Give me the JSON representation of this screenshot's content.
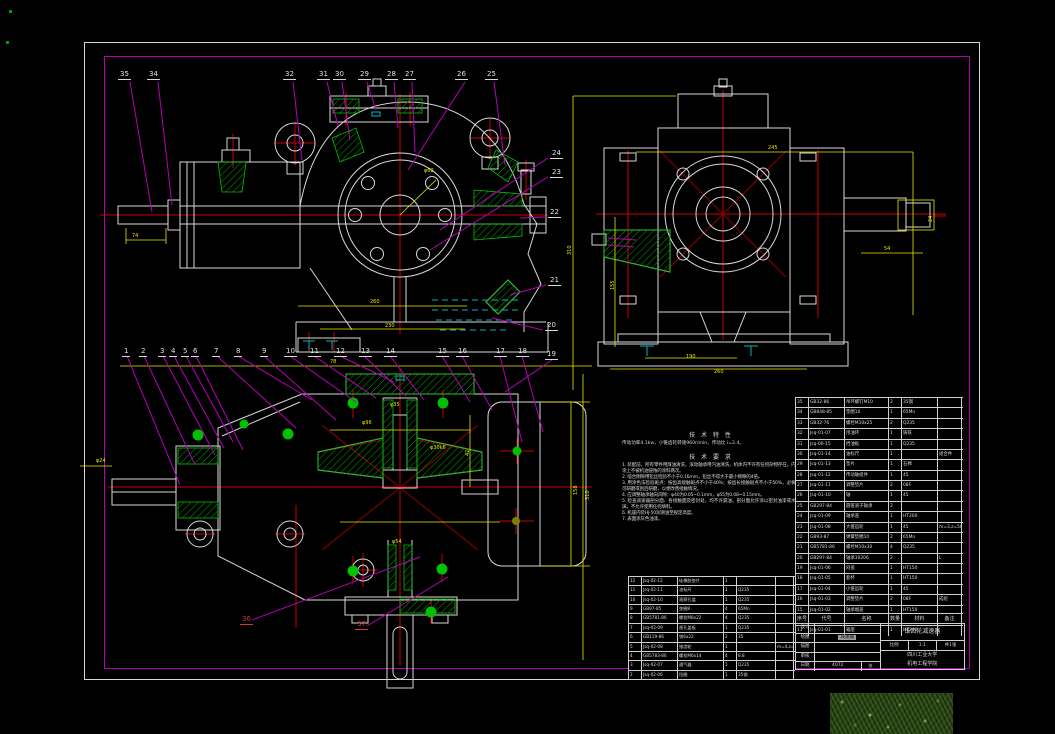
{
  "colors": {
    "background": "#000000",
    "line_white": "#d8d8d8",
    "leader_magenta": "#b800b8",
    "centerline_red": "#cc0000",
    "dim_yellow": "#e8e800",
    "hatch_green": "#00b000",
    "oil_cyan": "#00b8b8",
    "callout_text": "#e0e0e0"
  },
  "callouts": {
    "top": [
      {
        "t": "35",
        "x": 118,
        "y": 71
      },
      {
        "t": "34",
        "x": 147,
        "y": 71
      },
      {
        "t": "32",
        "x": 283,
        "y": 71
      },
      {
        "t": "31",
        "x": 317,
        "y": 71
      },
      {
        "t": "30",
        "x": 333,
        "y": 71
      },
      {
        "t": "29",
        "x": 358,
        "y": 71
      },
      {
        "t": "28",
        "x": 385,
        "y": 71
      },
      {
        "t": "27",
        "x": 403,
        "y": 71
      },
      {
        "t": "26",
        "x": 455,
        "y": 71
      },
      {
        "t": "25",
        "x": 485,
        "y": 71
      }
    ],
    "right": [
      {
        "t": "24",
        "x": 550,
        "y": 150
      },
      {
        "t": "23",
        "x": 550,
        "y": 169
      },
      {
        "t": "22",
        "x": 548,
        "y": 209
      },
      {
        "t": "21",
        "x": 548,
        "y": 277
      },
      {
        "t": "20",
        "x": 545,
        "y": 322
      }
    ],
    "bottom": [
      {
        "t": "1",
        "x": 122,
        "y": 348
      },
      {
        "t": "2",
        "x": 139,
        "y": 348
      },
      {
        "t": "3",
        "x": 158,
        "y": 348
      },
      {
        "t": "4",
        "x": 169,
        "y": 348
      },
      {
        "t": "5",
        "x": 181,
        "y": 348
      },
      {
        "t": "6",
        "x": 191,
        "y": 348
      },
      {
        "t": "7",
        "x": 212,
        "y": 348
      },
      {
        "t": "8",
        "x": 234,
        "y": 348
      },
      {
        "t": "9",
        "x": 260,
        "y": 348
      },
      {
        "t": "10",
        "x": 284,
        "y": 348
      },
      {
        "t": "11",
        "x": 308,
        "y": 348
      },
      {
        "t": "12",
        "x": 334,
        "y": 348
      },
      {
        "t": "13",
        "x": 359,
        "y": 348
      },
      {
        "t": "14",
        "x": 384,
        "y": 348
      },
      {
        "t": "15",
        "x": 436,
        "y": 348
      },
      {
        "t": "16",
        "x": 456,
        "y": 348
      },
      {
        "t": "17",
        "x": 494,
        "y": 348
      },
      {
        "t": "18",
        "x": 516,
        "y": 348
      },
      {
        "t": "19",
        "x": 545,
        "y": 351
      }
    ],
    "lower": [
      {
        "t": "36",
        "x": 240,
        "y": 616
      },
      {
        "t": "37",
        "x": 355,
        "y": 621
      }
    ]
  },
  "dims": [
    {
      "t": "74",
      "x": 132,
      "y": 234
    },
    {
      "t": "φ62",
      "x": 424,
      "y": 169
    },
    {
      "t": "260",
      "x": 370,
      "y": 300
    },
    {
      "t": "230",
      "x": 385,
      "y": 324
    },
    {
      "t": "245",
      "x": 768,
      "y": 146
    },
    {
      "t": "310",
      "x": 568,
      "y": 255,
      "r": -90
    },
    {
      "t": "155",
      "x": 611,
      "y": 290,
      "r": -90
    },
    {
      "t": "260",
      "x": 714,
      "y": 370
    },
    {
      "t": "190",
      "x": 686,
      "y": 355
    },
    {
      "t": "54",
      "x": 884,
      "y": 247
    },
    {
      "t": "24",
      "x": 929,
      "y": 222,
      "r": -90
    },
    {
      "t": "78",
      "x": 330,
      "y": 360
    },
    {
      "t": "φ24",
      "x": 96,
      "y": 459
    },
    {
      "t": "310",
      "x": 586,
      "y": 500,
      "r": -90
    },
    {
      "t": "158",
      "x": 574,
      "y": 495,
      "r": -90
    },
    {
      "t": "φ96",
      "x": 362,
      "y": 421
    },
    {
      "t": "42",
      "x": 466,
      "y": 456,
      "r": -90
    },
    {
      "t": "φ54",
      "x": 392,
      "y": 540
    },
    {
      "t": "φ35",
      "x": 390,
      "y": 403
    },
    {
      "t": "φ30k6",
      "x": 430,
      "y": 446
    }
  ],
  "notes": {
    "char_title": "技 术 特 性",
    "char_line": "传动功率4.1kw，小锥齿轮转速960r/min，传动比 i=2.4。",
    "req_title": "技 术 要 求",
    "items": [
      "1. 装配前，所有零件用煤油清洗，滚动轴承用汽油清洗，机体内不许有任何杂物存在。内壁涂上不被机油侵蚀的涂料两次。",
      "2. 啮合侧隙用铅丝检验不小于0.16mm，铅丝不得大于最小侧隙的4倍。",
      "3. 用涂色法检验斑点：按齿高接触斑点不小于40%；按齿长接触斑点不小于50%。必要时可研磨或刮后研磨，以便改善接触情况。",
      "4. 应调整轴承轴向间隙：φ40为0.05~0.1mm，φ55为0.08~0.15mm。",
      "5. 检查减速器剖分面、各接触面及密封处，均不许漏油。剖分面允许涂以密封油漆或水玻璃，不允许使用任何填料。",
      "6. 机座内装HJ-50润滑油至规定高度。",
      "7. 表面涂灰色油漆。"
    ]
  },
  "table_header": {
    "no": "序号",
    "code": "代号",
    "name": "名称",
    "qty": "数量",
    "mat": "材料",
    "note": "备注"
  },
  "bom_right": {
    "rows": [
      {
        "n": "35",
        "c": "GB32-86",
        "m": "吊环螺钉M10",
        "q": "2",
        "t": "35钢",
        "b": ""
      },
      {
        "n": "34",
        "c": "GB848-85",
        "m": "垫圈10",
        "q": "1",
        "t": "65Mn",
        "b": ""
      },
      {
        "n": "33",
        "c": "GB32-76",
        "m": "螺栓M10x25",
        "q": "2",
        "t": "Q235",
        "b": ""
      },
      {
        "n": "32",
        "c": "Jsq-01-07",
        "m": "甩油环",
        "q": "1",
        "t": "铸铁",
        "b": ""
      },
      {
        "n": "31",
        "c": "Jsq-00-15",
        "m": "挡油板",
        "q": "1",
        "t": "Q235",
        "b": ""
      },
      {
        "n": "30",
        "c": "Jsq-01-14",
        "m": "油标尺",
        "q": "1",
        "t": "",
        "b": "组合件"
      },
      {
        "n": "29",
        "c": "Jsq-01-13",
        "m": "垫片",
        "q": "1",
        "t": "石棉",
        "b": ""
      },
      {
        "n": "28",
        "c": "Jsq-01-12",
        "m": "传动轴组件",
        "q": "1",
        "t": "45",
        "b": ""
      },
      {
        "n": "27",
        "c": "Jsq-01-11",
        "m": "调整垫片",
        "q": "2",
        "t": "08F",
        "b": ""
      },
      {
        "n": "26",
        "c": "Jsq-01-10",
        "m": "轴",
        "q": "1",
        "t": "45",
        "b": ""
      },
      {
        "n": "25",
        "c": "GB297-84",
        "m": "圆锥滚子轴承",
        "q": "2",
        "t": "",
        "b": ""
      },
      {
        "n": "24",
        "c": "Jsq-01-09",
        "m": "轴承盖",
        "q": "1",
        "t": "HT200",
        "b": ""
      },
      {
        "n": "23",
        "c": "Jsq-01-08",
        "m": "大锥齿轮",
        "q": "1",
        "t": "45",
        "b": "m=3,z=50"
      },
      {
        "n": "22",
        "c": "GB93-87",
        "m": "弹簧垫圈10",
        "q": "2",
        "t": "65Mn",
        "b": ""
      },
      {
        "n": "21",
        "c": "GB5781-86",
        "m": "螺栓M10x30",
        "q": "4",
        "t": "Q235",
        "b": ""
      },
      {
        "n": "20",
        "c": "GB297-84",
        "m": "轴承30206",
        "q": "2",
        "t": "",
        "b": "L"
      },
      {
        "n": "19",
        "c": "Jsq-01-06",
        "m": "闷盖",
        "q": "1",
        "t": "HT150",
        "b": ""
      },
      {
        "n": "18",
        "c": "Jsq-01-05",
        "m": "套杯",
        "q": "1",
        "t": "HT150",
        "b": ""
      },
      {
        "n": "17",
        "c": "Jsq-01-04",
        "m": "小锥齿轮",
        "q": "1",
        "t": "45",
        "b": ""
      },
      {
        "n": "16",
        "c": "Jsq-01-03",
        "m": "调整垫片",
        "q": "2",
        "t": "08F",
        "b": "成组"
      },
      {
        "n": "15",
        "c": "Jsq-01-02",
        "m": "轴承端盖",
        "q": "1",
        "t": "HT150",
        "b": ""
      },
      {
        "n": "14",
        "c": "GB5782-86",
        "m": "螺栓M8x25",
        "q": "4",
        "t": "Q235",
        "b": ""
      },
      {
        "n": "13",
        "c": "Jsq-01-01",
        "m": "箱座",
        "q": "1",
        "t": "HT200",
        "b": ""
      }
    ]
  },
  "bom_left": {
    "rows": [
      {
        "n": "12",
        "c": "Jsq-02-12",
        "m": "硅橡胶垫片",
        "q": "1",
        "t": "",
        "b": ""
      },
      {
        "n": "11",
        "c": "Jsq-02-11",
        "m": "油标尺",
        "q": "1",
        "t": "Q235",
        "b": ""
      },
      {
        "n": "10",
        "c": "Jsq-02-10",
        "m": "观察孔盖",
        "q": "1",
        "t": "Q235",
        "b": ""
      },
      {
        "n": "9",
        "c": "GB97-85",
        "m": "垫圈8",
        "q": "4",
        "t": "65Mn",
        "b": ""
      },
      {
        "n": "8",
        "c": "GB5781-86",
        "m": "螺栓M8x22",
        "q": "4",
        "t": "Q235",
        "b": ""
      },
      {
        "n": "7",
        "c": "Jsq-02-09",
        "m": "视孔盖板",
        "q": "1",
        "t": "Q235",
        "b": ""
      },
      {
        "n": "6",
        "c": "GB119-86",
        "m": "销6x22",
        "q": "2",
        "t": "35",
        "b": ""
      },
      {
        "n": "5",
        "c": "Jsq-02-08",
        "m": "锥齿轮",
        "q": "1",
        "t": "",
        "b": "m=4,z=21"
      },
      {
        "n": "4",
        "c": "GB5783-86",
        "m": "螺栓M6x14",
        "q": "4",
        "t": "8.8",
        "b": ""
      },
      {
        "n": "3",
        "c": "Jsq-02-07",
        "m": "通气器",
        "q": "1",
        "t": "Q235",
        "b": ""
      },
      {
        "n": "2",
        "c": "Jsq-02-06",
        "m": "挡圈",
        "q": "1",
        "t": "35钢",
        "b": ""
      }
    ]
  },
  "title_block": {
    "row_labels": [
      "设计",
      "绘图",
      "描图",
      "审核",
      "日期"
    ],
    "highlighted_name": "减速器",
    "drawing_no": "4072",
    "sheet_ext": "张",
    "title": "锥齿轮减速器",
    "scale_label": "比例",
    "scale": "1:1",
    "qty_label": "共1张",
    "org_line1": "四川工业大学",
    "org_line2": "机电工程学院"
  }
}
